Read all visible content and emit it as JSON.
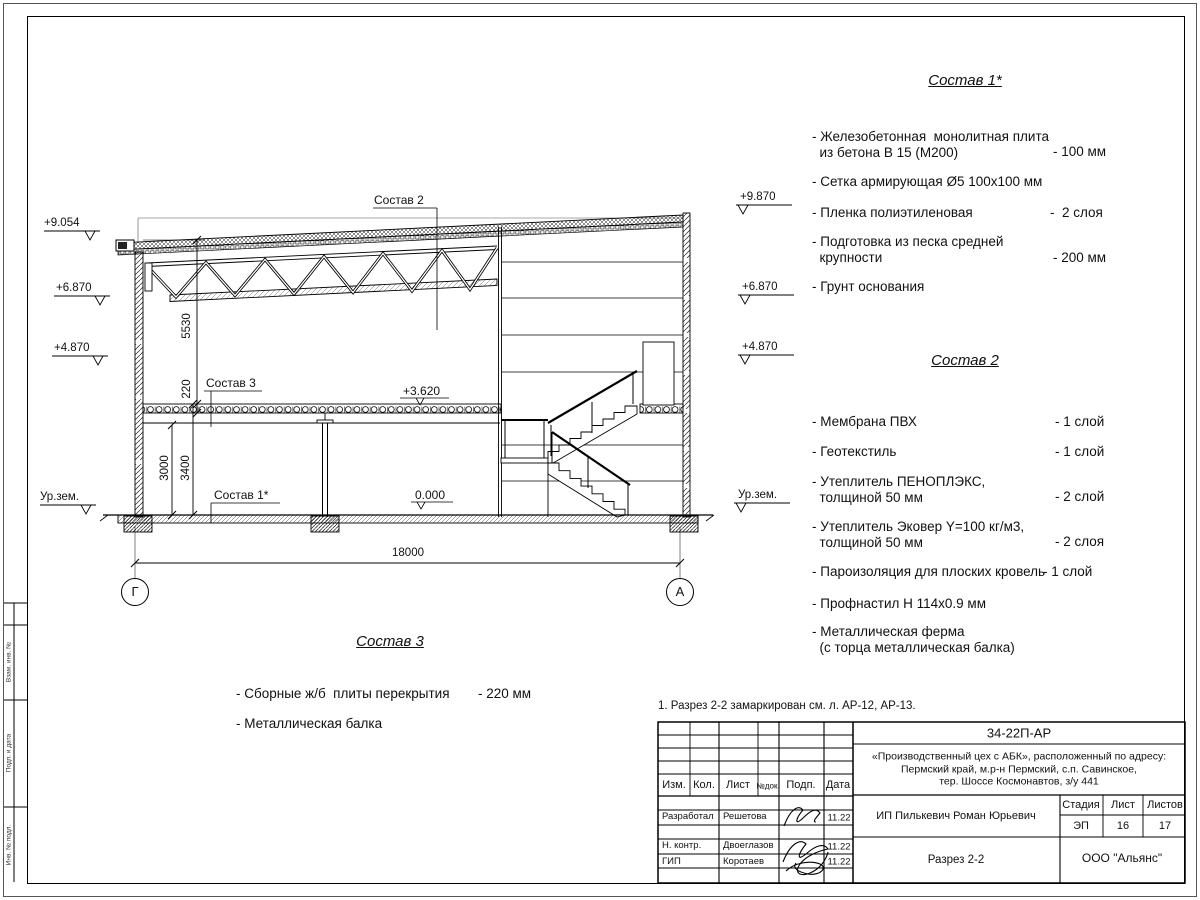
{
  "drawing": {
    "axis_left": "Г",
    "axis_right": "А",
    "marks_left": [
      "+9.054",
      "+6.870",
      "+4.870",
      "Ур.зем."
    ],
    "marks_right": [
      "+9.870",
      "+6.870",
      "+4.870",
      "Ур.зем."
    ],
    "dims": {
      "truss_zone": "5530",
      "slab_thickness": "220",
      "clear_height": "3000",
      "floor_to_slab": "3400",
      "span": "18000",
      "level_slab": "+3.620",
      "level_zero": "0.000"
    },
    "callouts": {
      "sostav1": "Состав 1*",
      "sostav2": "Состав 2",
      "sostav3": "Состав 3"
    }
  },
  "lists": {
    "s1": {
      "title": "Состав 1*",
      "items": [
        {
          "text": "- Железобетонная  монолитная плита\n  из бетона В 15 (М200)",
          "value": "- 100 мм"
        },
        {
          "text": "- Сетка армирующая Ø5 100х100 мм",
          "value": ""
        },
        {
          "text": "- Пленка полиэтиленовая",
          "value": "-  2 слоя"
        },
        {
          "text": "- Подготовка из песка средней\n  крупности",
          "value": "- 200 мм"
        },
        {
          "text": "- Грунт основания",
          "value": ""
        }
      ]
    },
    "s2": {
      "title": "Состав 2",
      "items": [
        {
          "text": "- Мембрана ПВХ",
          "value": "- 1 слой"
        },
        {
          "text": "- Геотекстиль",
          "value": "- 1 слой"
        },
        {
          "text": "- Утеплитель ПЕНОПЛЭКС,\n  толщиной 50 мм",
          "value": "- 2 слой"
        },
        {
          "text": "- Утеплитель Эковер Y=100 кг/м3,\n  толщиной 50 мм",
          "value": "- 2 слоя"
        },
        {
          "text": "- Пароизоляция для плоских кровель",
          "value": "- 1 слой"
        },
        {
          "text": "- Профнастил Н 114х0.9 мм",
          "value": ""
        },
        {
          "text": "- Металлическая ферма\n  (с торца металлическая балка)",
          "value": ""
        }
      ]
    },
    "s3": {
      "title": "Состав 3",
      "items": [
        {
          "text": "- Сборные ж/б  плиты перекрытия",
          "value": "- 220 мм"
        },
        {
          "text": "- Металлическая балка",
          "value": ""
        }
      ]
    }
  },
  "note": "1. Разрез 2-2 замаркирован см. л. АР-12, АР-13.",
  "stamp": {
    "doc_number": "34-22П-АР",
    "project": "«Производственный цех с АБК», расположенный по адресу:\nПермский край, м.р-н Пермский, с.п. Савинское,\nтер. Шоссе Космонавтов, з/у 441",
    "headers": {
      "izm": "Изм.",
      "kol": "Кол.",
      "list": "Лист",
      "ndok": "№док.",
      "podp": "Подп.",
      "data": "Дата"
    },
    "rows": [
      {
        "role": "Разработал",
        "name": "Решетова",
        "date": "11.22"
      },
      {
        "role": "Н. контр.",
        "name": "Двоеглазов",
        "date": "11.22"
      },
      {
        "role": "ГИП",
        "name": "Коротаев",
        "date": "11.22"
      }
    ],
    "client": "ИП Пилькевич Роман Юрьевич",
    "stage_label": "Стадия",
    "sheet_label": "Лист",
    "sheets_label": "Листов",
    "stage": "ЭП",
    "sheet": "16",
    "sheets": "17",
    "sheet_title": "Разрез 2-2",
    "company": "ООО \"Альянс\""
  },
  "side_stamp": {
    "row1": "Взам. инв. №",
    "row2": "Подп. и дата",
    "row3": "Инв. № подл."
  }
}
